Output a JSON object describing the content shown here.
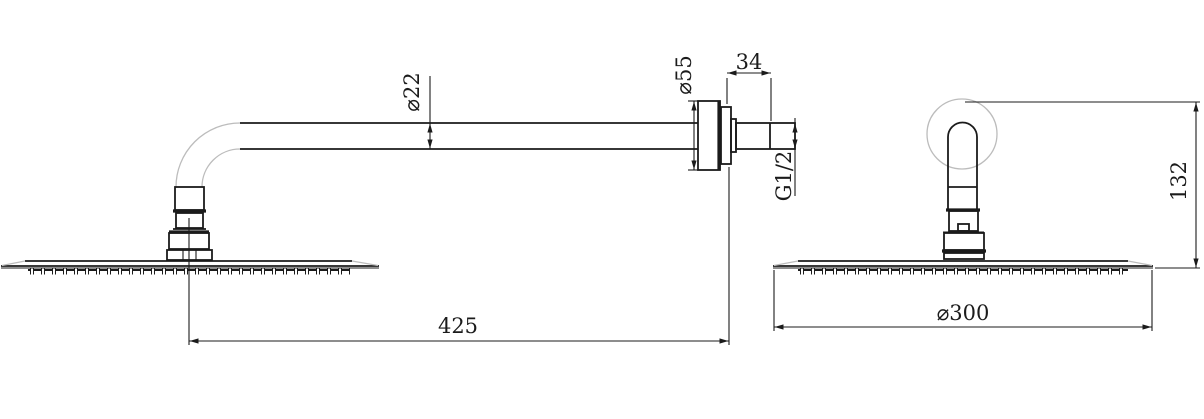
{
  "drawing": {
    "type": "technical-dimension-drawing",
    "subject": "wall-mounted rain shower head with shower arm, two orthographic views",
    "colors": {
      "line": "#1b1b1b",
      "light_line": "#bcbcbc",
      "background": "#ffffff"
    },
    "dimensions": {
      "arm_diameter": "⌀22",
      "flange_diameter": "⌀55",
      "flange_depth": "34",
      "thread_size": "G1/2",
      "arm_length": "425",
      "head_diameter": "⌀300",
      "drop_height": "132"
    }
  }
}
